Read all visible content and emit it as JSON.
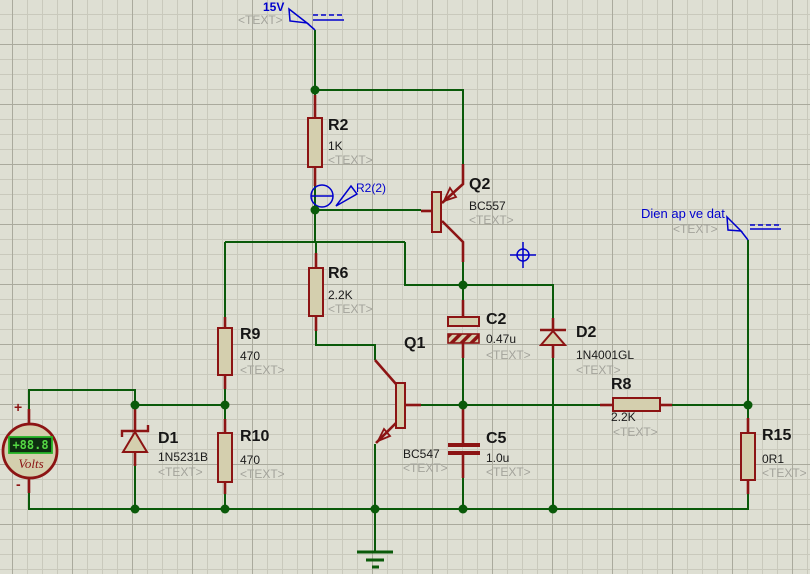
{
  "colors": {
    "bg": "#dedfd3",
    "gridMinor": "#c9c9bc",
    "gridMajor": "#aaaa9d",
    "wire": "#0a5a0a",
    "lead": "#8c1414",
    "body": "#d4cfae",
    "blue": "#0000cd",
    "lcdBg": "#0e2e10",
    "lcdBorder": "#25b325",
    "lcdText": "#55d944"
  },
  "power": {
    "vcc": {
      "label": "15V",
      "placeholder": "<TEXT>"
    },
    "out": {
      "label": "Dien ap ve dat",
      "placeholder": "<TEXT>"
    }
  },
  "probe": {
    "label": "R2(2)"
  },
  "meter": {
    "reading": "+88.8",
    "unit": "Volts",
    "plus": "+",
    "minus": "-"
  },
  "parts": {
    "r2": {
      "ref": "R2",
      "value": "1K",
      "placeholder": "<TEXT>"
    },
    "r6": {
      "ref": "R6",
      "value": "2.2K",
      "placeholder": "<TEXT>"
    },
    "r9": {
      "ref": "R9",
      "value": "470",
      "placeholder": "<TEXT>"
    },
    "r10": {
      "ref": "R10",
      "value": "470",
      "placeholder": "<TEXT>"
    },
    "r8": {
      "ref": "R8",
      "value": "2.2K",
      "placeholder": "<TEXT>"
    },
    "r15": {
      "ref": "R15",
      "value": "0R1",
      "placeholder": "<TEXT>"
    },
    "q1": {
      "ref": "Q1",
      "value": "BC547",
      "placeholder": "<TEXT>"
    },
    "q2": {
      "ref": "Q2",
      "value": "BC557",
      "placeholder": "<TEXT>"
    },
    "c2": {
      "ref": "C2",
      "value": "0.47u",
      "placeholder": "<TEXT>"
    },
    "c5": {
      "ref": "C5",
      "value": "1.0u",
      "placeholder": "<TEXT>"
    },
    "d1": {
      "ref": "D1",
      "value": "1N5231B",
      "placeholder": "<TEXT>"
    },
    "d2": {
      "ref": "D2",
      "value": "1N4001GL",
      "placeholder": "<TEXT>"
    }
  }
}
